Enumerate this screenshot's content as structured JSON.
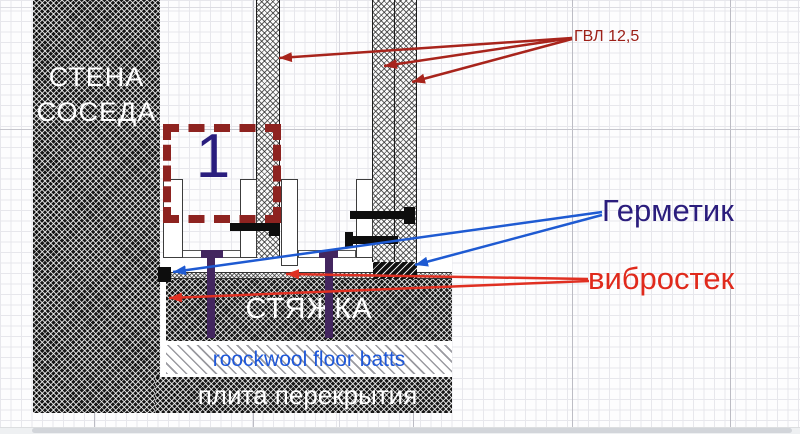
{
  "diagram": {
    "neighbor_wall": {
      "line1": "СТЕНА",
      "line2": "СОСЕДА"
    },
    "callout": {
      "number": "1"
    },
    "labels": {
      "gvl": "ГВЛ 12,5",
      "sealant": "Герметик",
      "vibrostek": "вибростек",
      "screed": "СТЯЖКА",
      "rockwool": "roockwool floor batts",
      "slab": "плита перекрытия"
    },
    "colors": {
      "gvl_label": "#9c2018",
      "sealant_label": "#2b1d7d",
      "vibrostek_label": "#e02a1c",
      "callout_box": "#8e2320",
      "callout_number": "#2a1e7e",
      "anchor_pin": "#43265f",
      "arrow_red_dark": "#a8241c",
      "arrow_red_bright": "#e03022",
      "arrow_blue": "#1e5ad2",
      "rockwool_text": "#1f58d8"
    }
  }
}
